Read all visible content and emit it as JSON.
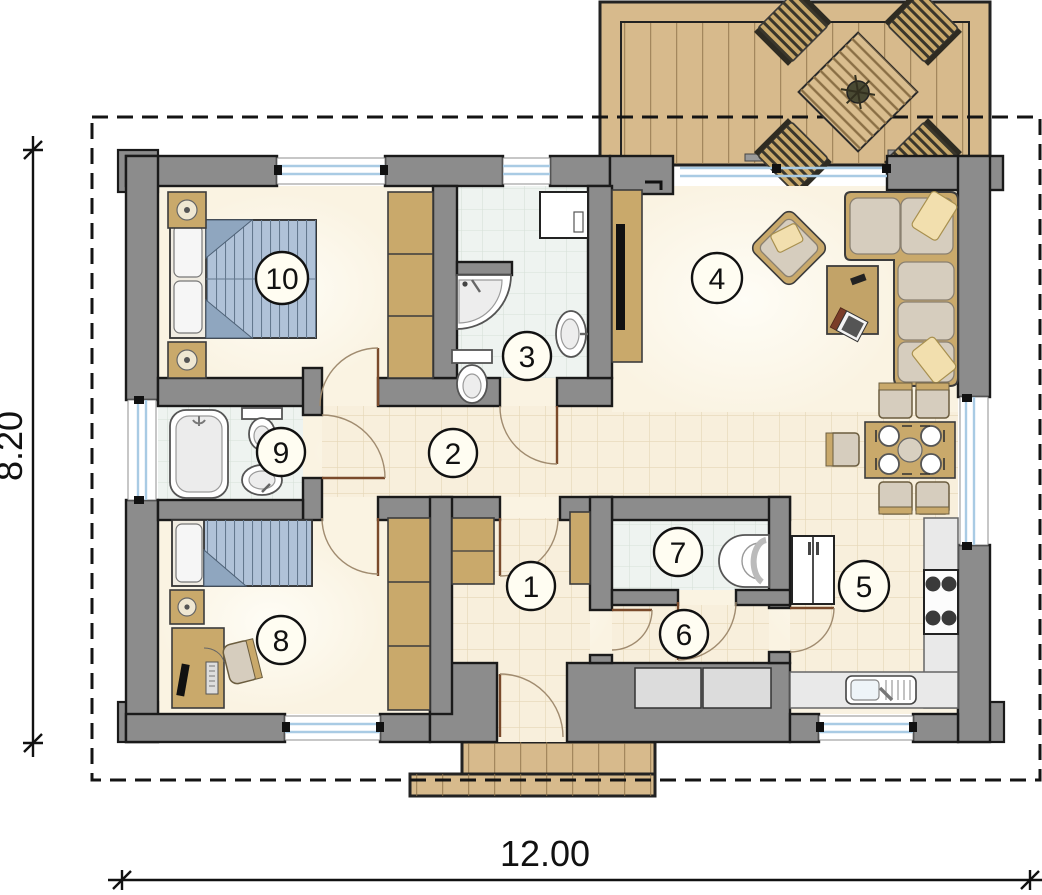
{
  "plan": {
    "dimensions": {
      "width_m": "12.00",
      "height_m": "8.20"
    },
    "rooms": [
      {
        "id": 1,
        "label": "1"
      },
      {
        "id": 2,
        "label": "2"
      },
      {
        "id": 3,
        "label": "3"
      },
      {
        "id": 4,
        "label": "4"
      },
      {
        "id": 5,
        "label": "5"
      },
      {
        "id": 6,
        "label": "6"
      },
      {
        "id": 7,
        "label": "7"
      },
      {
        "id": 8,
        "label": "8"
      },
      {
        "id": 9,
        "label": "9"
      },
      {
        "id": 10,
        "label": "10"
      }
    ]
  },
  "colors": {
    "wall": "#8c8c8c",
    "deck": "#d7ba8c",
    "wood": "#c9a96b",
    "floor": "#faf3e2",
    "floor_tile": "#f8efdc",
    "floor_line": "#e5d6b6",
    "bath": "#eef3f0",
    "bath_line": "#d6e0d8",
    "bed": "#b0c2d8",
    "bed_line": "#64788e",
    "sofa": "#d6cdbe",
    "pillow": "#f2dfae",
    "window": "#a9cbe4",
    "door": "#7a4a2b",
    "arc": "#a08b6f",
    "counter": "#e9e9e9",
    "label_bg": "#fffdf2"
  }
}
